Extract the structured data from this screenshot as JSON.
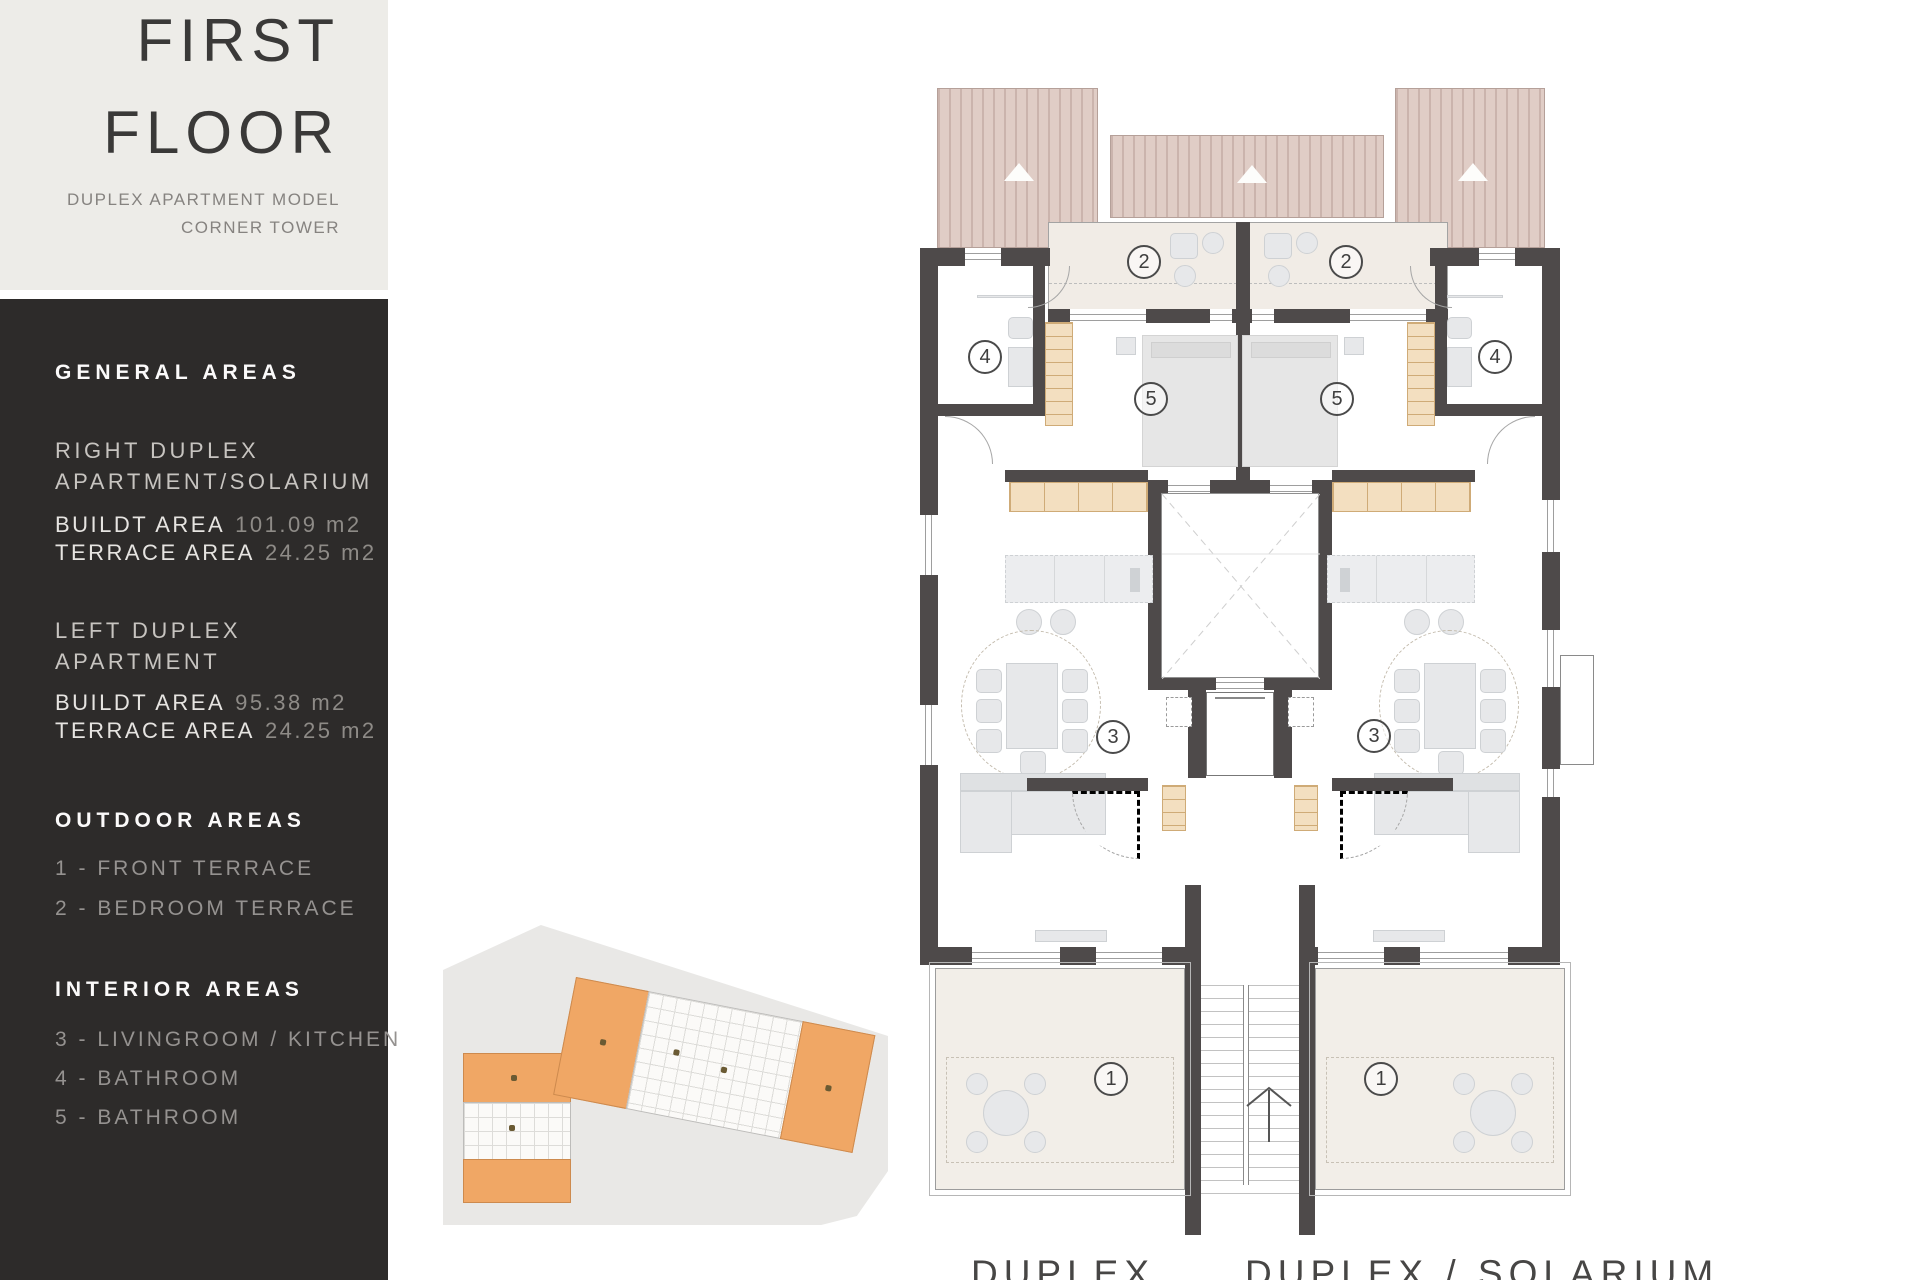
{
  "title_block": {
    "title_line1": "FIRST",
    "title_line2": "FLOOR",
    "subtitle_line1": "DUPLEX APARTMENT MODEL",
    "subtitle_line2": "CORNER TOWER"
  },
  "sidebar": {
    "general": {
      "heading": "GENERAL AREAS",
      "right_duplex": {
        "name_line1": "RIGHT DUPLEX",
        "name_line2": "APARTMENT/SOLARIUM",
        "built_label": "BUILDT AREA",
        "built_value": "101.09 m2",
        "terrace_label": "TERRACE AREA",
        "terrace_value": "24.25  m2"
      },
      "left_duplex": {
        "name_line1": "LEFT DUPLEX",
        "name_line2": "APARTMENT",
        "built_label": "BUILDT AREA",
        "built_value": "95.38 m2",
        "terrace_label": "TERRACE AREA",
        "terrace_value": "24.25 m2"
      }
    },
    "outdoor": {
      "heading": "OUTDOOR AREAS",
      "items": [
        "1 - FRONT TERRACE",
        "2 - BEDROOM TERRACE"
      ]
    },
    "interior": {
      "heading": "INTERIOR AREAS",
      "items": [
        "3 - LIVINGROOM / KITCHEN",
        "4 - BATHROOM",
        "5 - BATHROOM"
      ]
    }
  },
  "plan": {
    "markers": {
      "front_terrace": "1",
      "bedroom_terrace": "2",
      "living_kitchen": "3",
      "bathroom4": "4",
      "bathroom5": "5"
    },
    "unit_labels": {
      "left": "DUPLEX",
      "right": "DUPLEX / SOLARIUM"
    }
  },
  "palette": {
    "sidebar_bg": "#2d2b2a",
    "title_bg": "#edece8",
    "wall": "#4e4a4a",
    "roof": "#e0cdc6",
    "roof_stripe": "#cbb4ad",
    "terrace_floor": "#f2eee8",
    "closet_tan": "#f3dfc0",
    "furniture_gray": "#e7e8ea",
    "site_orange": "#f0a765",
    "site_gray": "#e9e8e6"
  }
}
